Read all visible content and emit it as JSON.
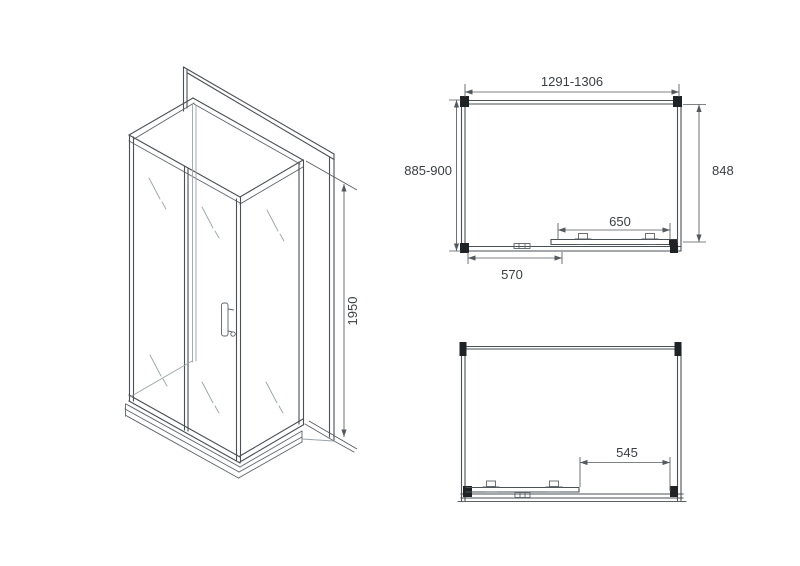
{
  "views": {
    "isometric": {
      "height_dim": "1950"
    },
    "top_plan": {
      "width_dim": "1291-1306",
      "depth_dim": "885-900",
      "inner_depth_dim": "848",
      "door_dim": "650",
      "panel_dim": "570"
    },
    "front_plan": {
      "opening_dim": "545"
    }
  },
  "colors": {
    "background": "#ffffff",
    "line": "#4b5054",
    "hidden_line": "#9aa3a8",
    "dimension": "#55595d",
    "text": "#3a3e42",
    "corner_post": "#1f2326"
  }
}
